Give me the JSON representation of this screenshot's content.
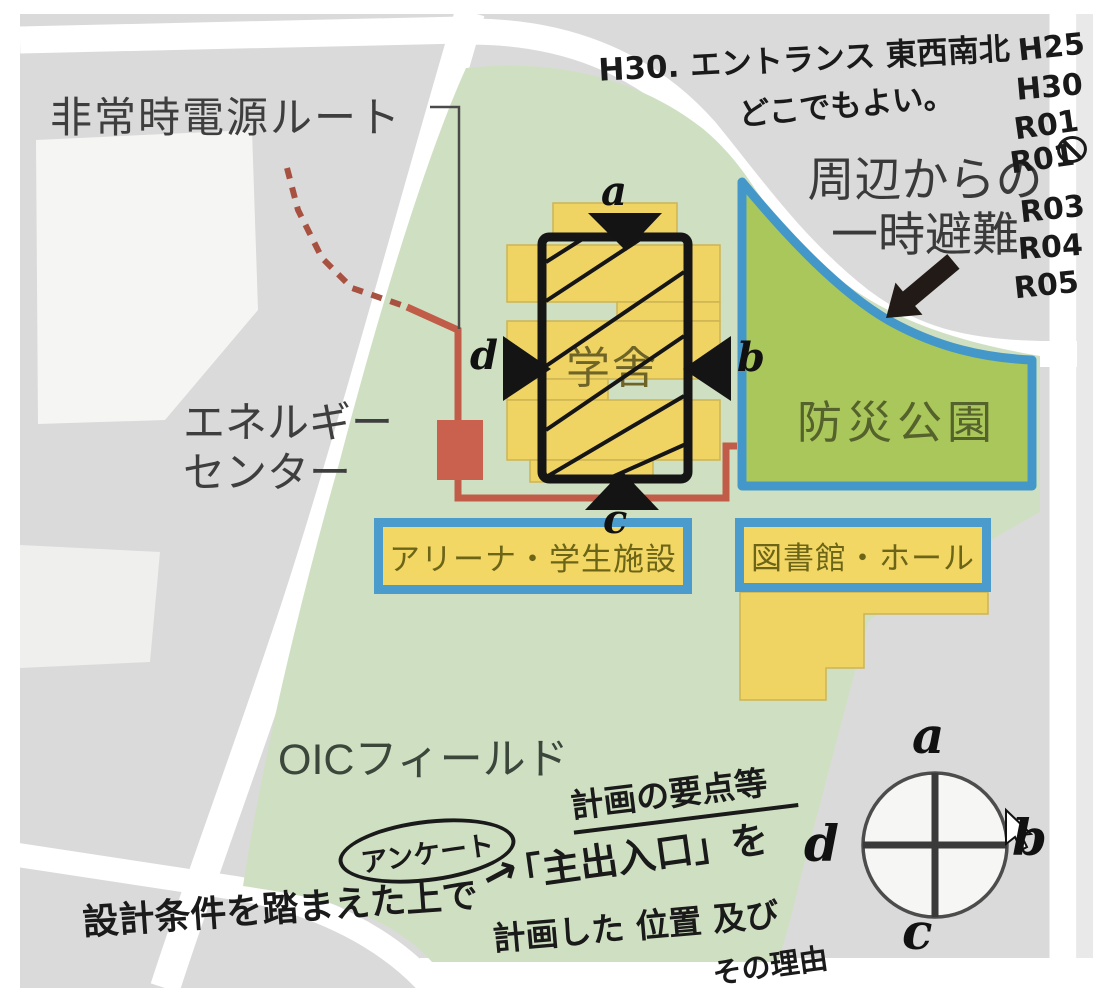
{
  "map": {
    "printed_labels": {
      "emergency_power_route": "非常時電源ルート",
      "energy_center_line1": "エネルギー",
      "energy_center_line2": "センター",
      "school_building": "学舎",
      "disaster_park": "防災公園",
      "evacuation_line1": "周辺からの",
      "evacuation_line2": "一時避難",
      "oic_field": "OICフィールド"
    },
    "boxes": {
      "arena": "アリーナ・学生施設",
      "library": "図書館・ホール"
    },
    "building_letters": {
      "top": "a",
      "right": "b",
      "bottom": "c",
      "left": "d"
    },
    "compass_letters": {
      "top": "a",
      "right": "b",
      "bottom": "c",
      "left": "d"
    },
    "handwritten": {
      "entrance_note_line1": "H30. エントランス 東西南北",
      "entrance_note_line2": "どこでもよい。",
      "year_list": [
        "H25",
        "H30",
        "R01",
        "R01",
        "R03",
        "R04",
        "R05"
      ],
      "year_list_marked_index": 3,
      "plan_points": "計画の要点等",
      "questionnaire": "アンケート",
      "questionnaire_arrow": "→",
      "main_entrance": "「主出入口」を",
      "planned_position": "計画した 位置 及び",
      "reason": "その理由",
      "design_conditions": "設計条件を踏まえた上で"
    },
    "icons": {
      "year_mark": "circled-scribble",
      "cursor": "mouse-arrow-pointer"
    },
    "colors": {
      "map_gray": "#dadada",
      "road_white": "#ffffff",
      "campus_green": "#cfe0c2",
      "park_green": "#aac75c",
      "border_blue": "#4b9ccd",
      "building_yellow": "#efd463",
      "route_red": "#c05c48",
      "energy_center_red": "#c9614e",
      "ink_black": "#1a1a1a"
    }
  }
}
